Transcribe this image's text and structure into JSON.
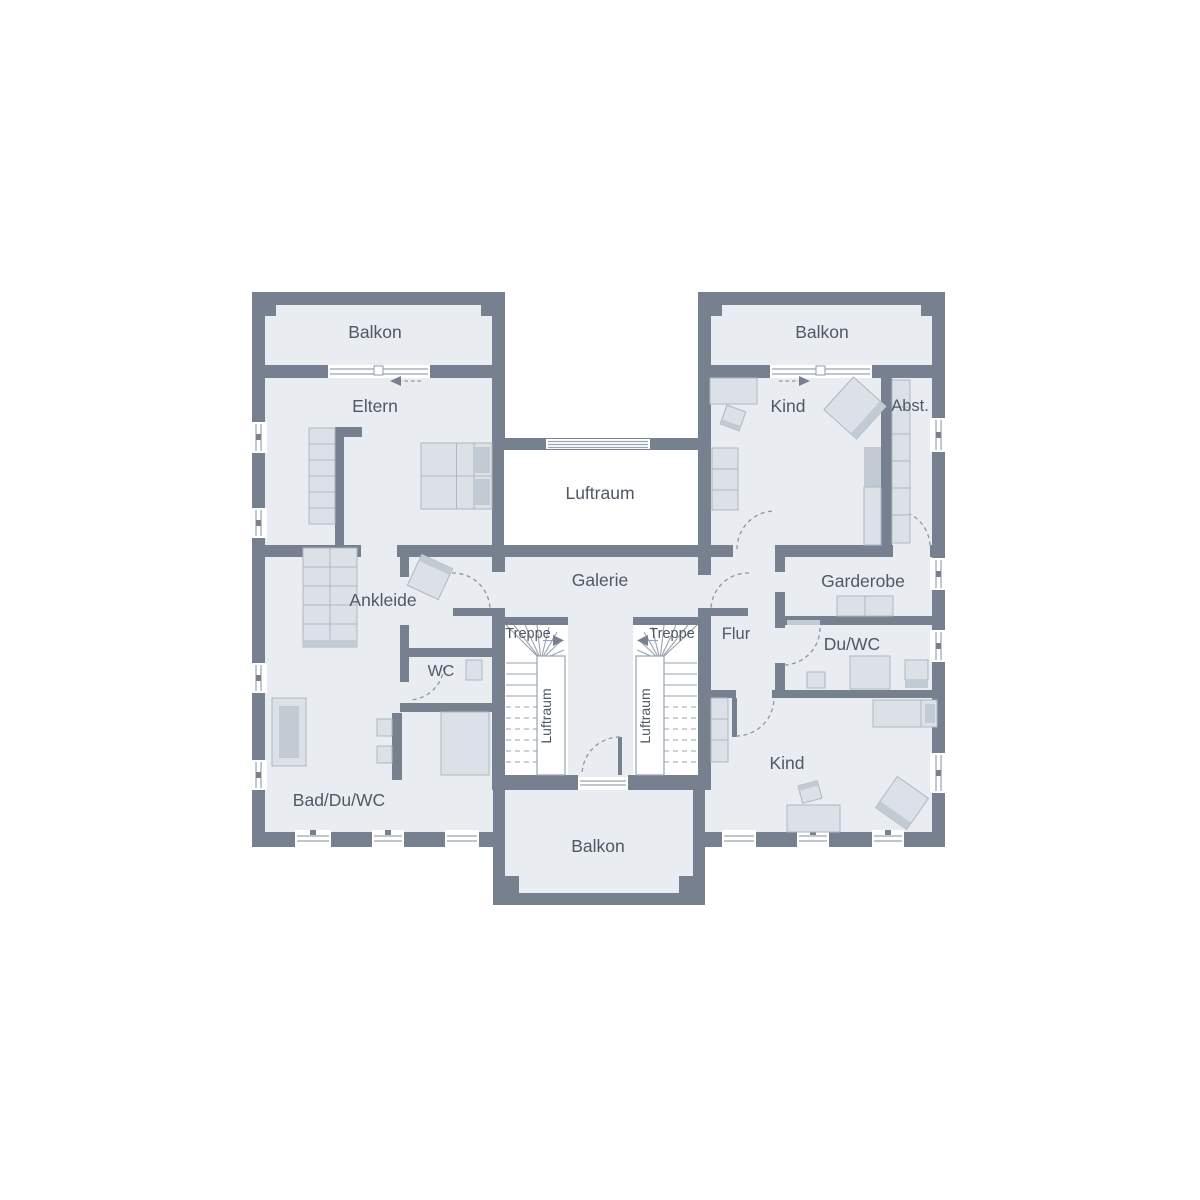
{
  "rooms": {
    "balkon_left": "Balkon",
    "balkon_right": "Balkon",
    "balkon_bottom": "Balkon",
    "eltern": "Eltern",
    "kind_top": "Kind",
    "kind_bottom": "Kind",
    "abst": "Abst.",
    "luftraum": "Luftraum",
    "luftraum_stair_left": "Luftraum",
    "luftraum_stair_right": "Luftraum",
    "galerie": "Galerie",
    "ankleide": "Ankleide",
    "garderobe": "Garderobe",
    "treppe_left": "Treppe",
    "treppe_right": "Treppe",
    "flur": "Flur",
    "wc": "WC",
    "du_wc": "Du/WC",
    "bad_du_wc": "Bad/Du/WC"
  },
  "colors": {
    "wall": "#76808f",
    "floor": "#e9ecf1",
    "white": "#ffffff",
    "furn": "#dce1e8",
    "furnDark": "#c2cad4",
    "furnLine": "#aeb6c2",
    "stairLine": "#9aa3b0",
    "dashLine": "#8d96a4",
    "text": "#4e5965"
  }
}
